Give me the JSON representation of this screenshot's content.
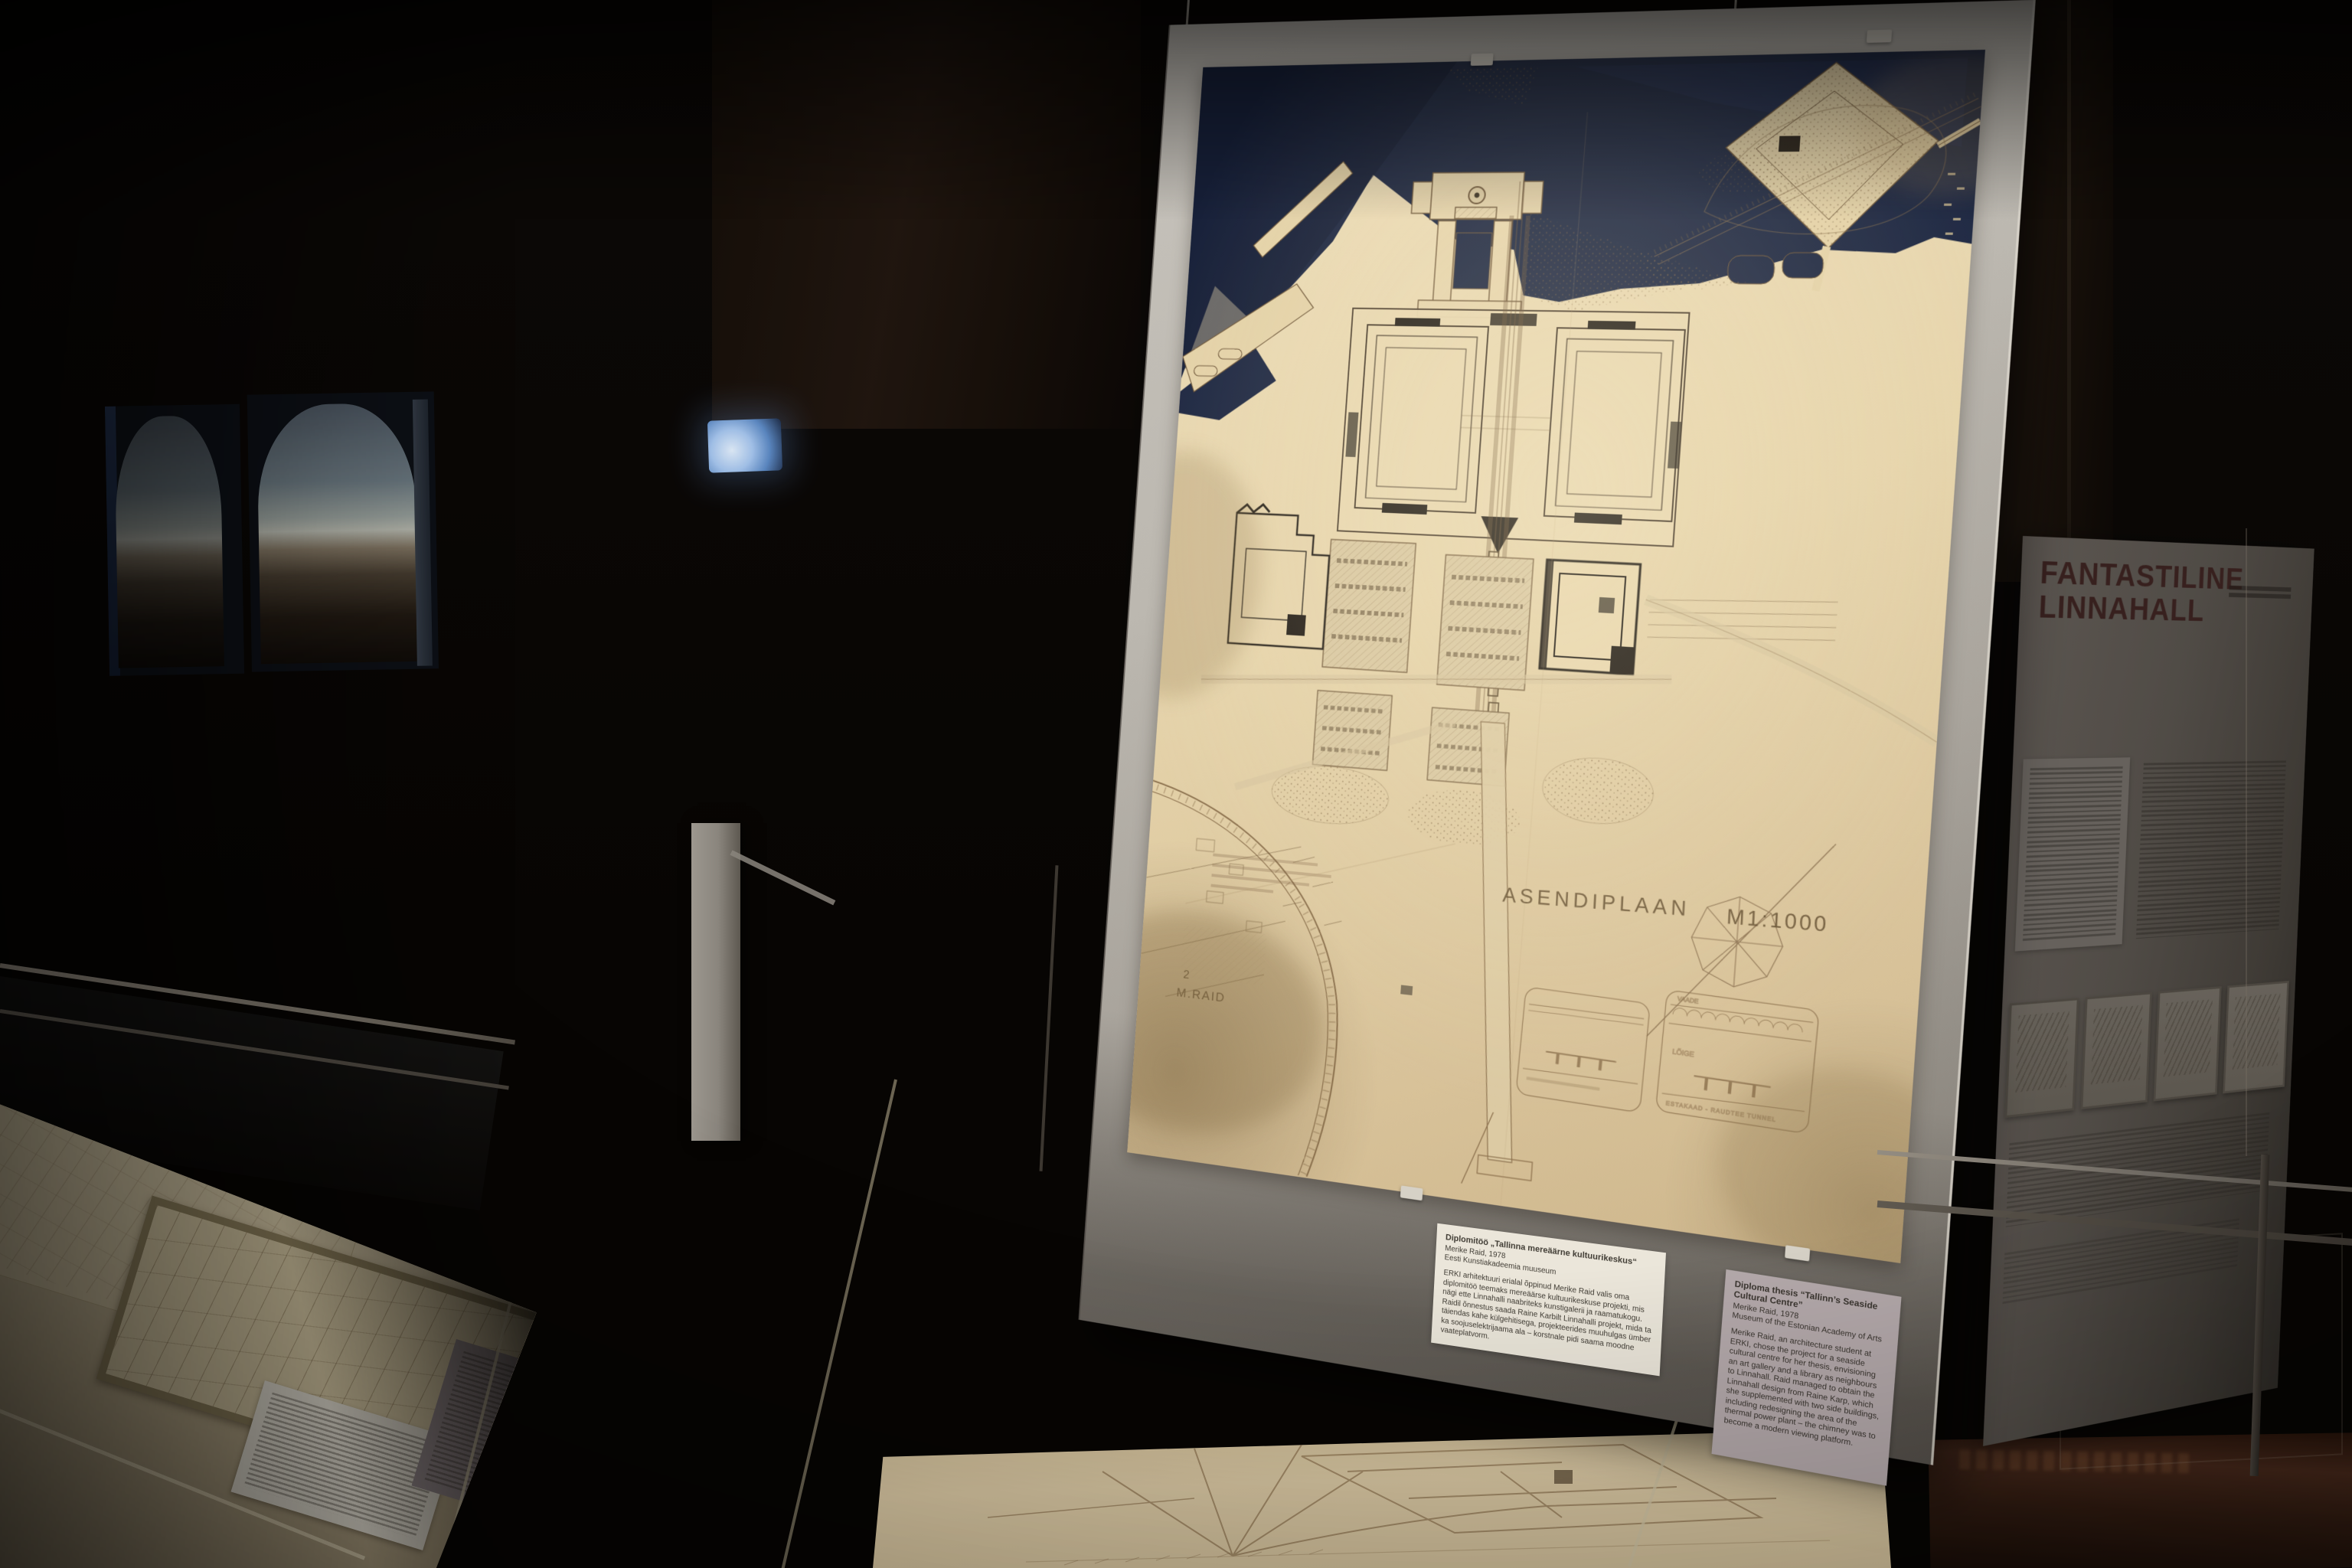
{
  "main_panel": {
    "plan": {
      "title": "ASENDIPLAAN",
      "scale": "M1:1000",
      "sheet_number": "2",
      "signature": "M.RAID",
      "detail_label_view": "VAADE",
      "detail_label_section": "LÕIGE",
      "detail_label_viaduct": "ESTAKAAD - RAUDTEE TUNNEL"
    },
    "caption_et": {
      "title": "Diplomitöö „Tallinna mereäärne kultuurikeskus“",
      "author_year": "Merike Raid, 1978",
      "museum": "Eesti Kunstiakadeemia muuseum",
      "body": "ERKI arhitektuuri erialal õppinud Merike Raid valis oma diplomitöö teemaks mereäärse kultuurikeskuse projekti, mis nägi ette Linnahalli naabriteks kunstigalerii ja raamatukogu. Raidil õnnestus saada Raine Karbilt Linnahalli projekt, mida ta täiendas kahe külgehitisega, projekteerides muuhulgas ümber ka soojuselektrijaama ala – korstnale pidi saama moodne vaateplatvorm."
    },
    "caption_en": {
      "title": "Diploma thesis “Tallinn’s Seaside Cultural Centre”",
      "author_year": "Merike Raid, 1978",
      "museum": "Museum of the Estonian Academy of Arts",
      "body": "Merike Raid, an architecture student at ERKI, chose the project for a seaside cultural centre for her thesis, envisioning an art gallery and a library as neighbours to Linnahall. Raid managed to obtain the Linnahall design from Raine Karp, which she supplemented with two side buildings, including redesigning the area of the thermal power plant – the chimney was to become a modern viewing platform."
    }
  },
  "right_panel": {
    "title_line1": "FANTASTILINE",
    "title_line2": "LINNAHALL"
  },
  "colors": {
    "background": "#070503",
    "sea": "#1d2742",
    "paper": "#e7d6b0",
    "plan_ink": "#7a5f40",
    "board_grey": "#b5b1a9",
    "panel_title_maroon": "#5d332e",
    "caption_card_white": "#ebe6da",
    "caption_card_grey": "#b4a9ab"
  }
}
